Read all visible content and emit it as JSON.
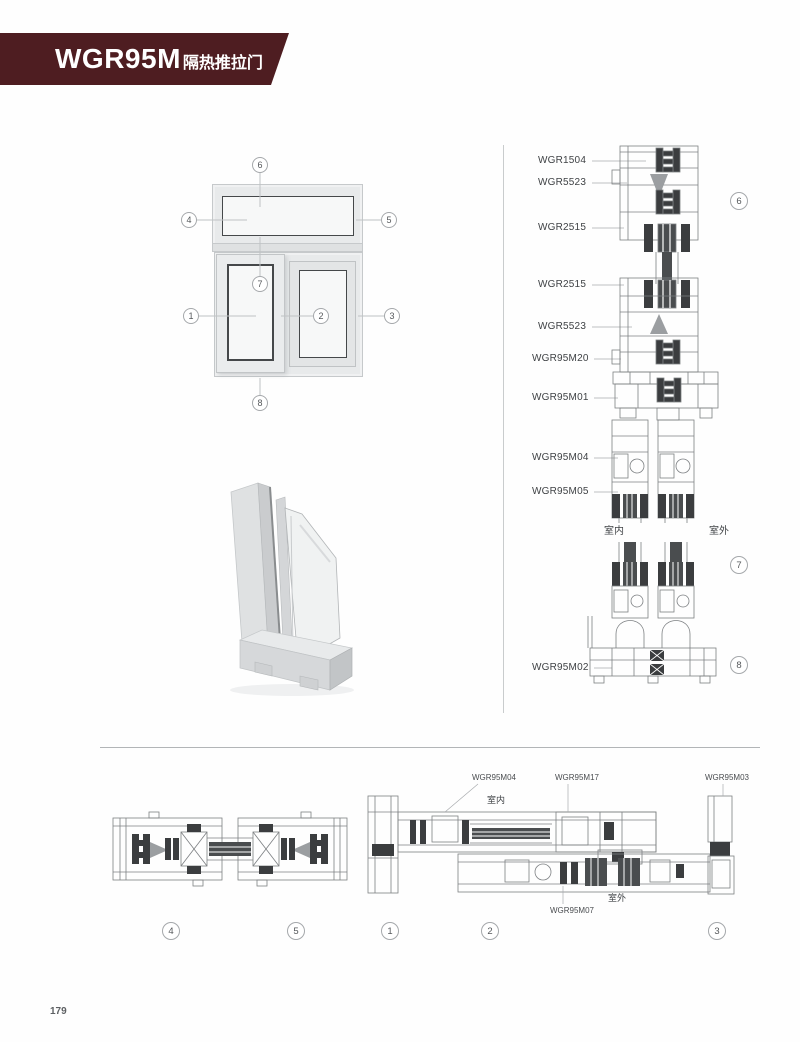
{
  "page": {
    "number": "179"
  },
  "header": {
    "model": "WGR95M",
    "subtitle": "隔热推拉门",
    "banner_color": "#4e1d21"
  },
  "env": {
    "indoor": "室内",
    "outdoor": "室外"
  },
  "callouts": [
    "1",
    "2",
    "3",
    "4",
    "5",
    "6",
    "7",
    "8"
  ],
  "vertical_section": {
    "labels": [
      "WGR1504",
      "WGR5523",
      "WGR2515",
      "WGR2515",
      "WGR5523",
      "WGR95M20",
      "WGR95M01",
      "WGR95M04",
      "WGR95M05",
      "WGR95M02"
    ]
  },
  "horizontal_section": {
    "labels": [
      "WGR95M04",
      "WGR95M17",
      "WGR95M03",
      "WGR95M07"
    ]
  },
  "colors": {
    "drawing_line": "#7d8083",
    "thermal_break": "#3b3d3f"
  }
}
